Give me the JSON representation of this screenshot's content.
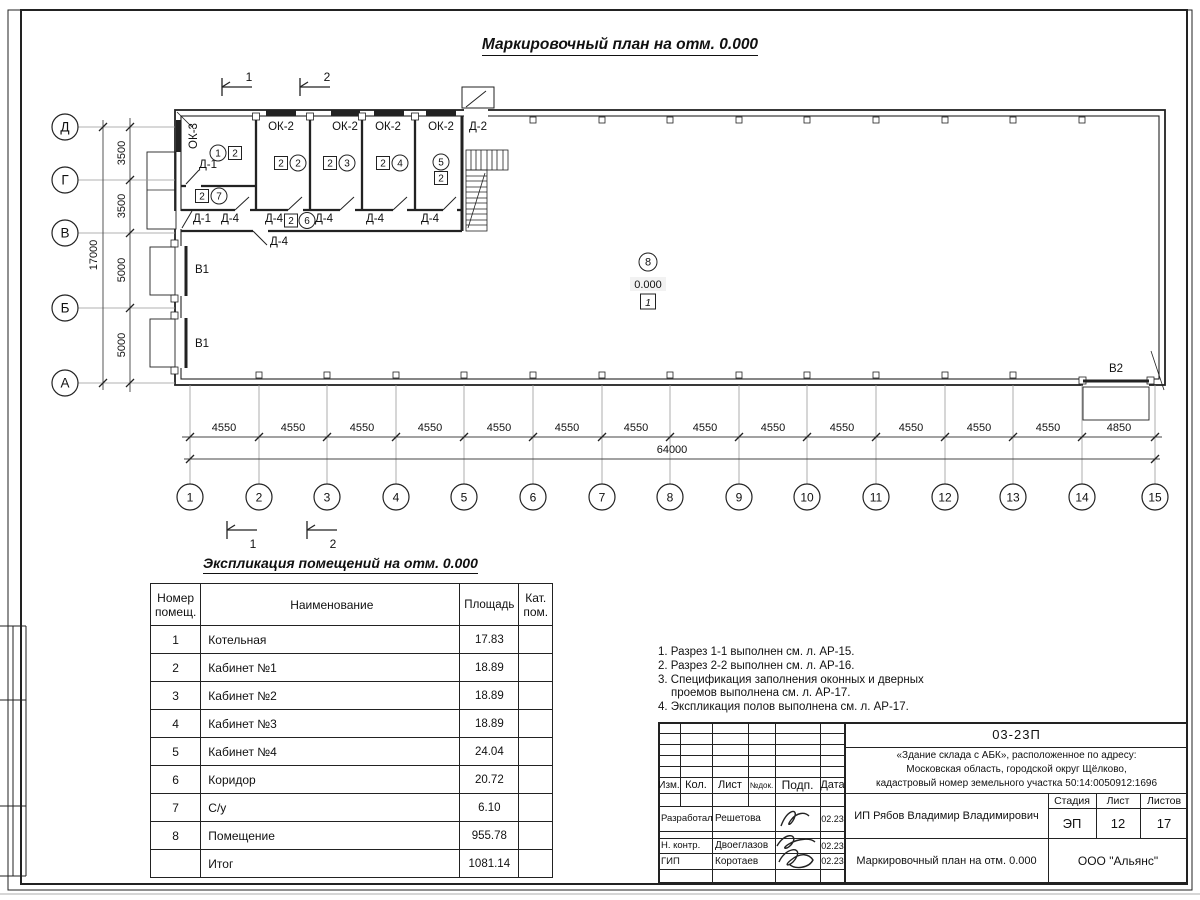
{
  "sheet": {
    "title": "Маркировочный план на отм. 0.000",
    "table_title": "Экспликация помещений на отм. 0.000"
  },
  "plan": {
    "axes_left": [
      "Д",
      "Г",
      "В",
      "Б",
      "А"
    ],
    "axes_bottom": [
      "1",
      "2",
      "3",
      "4",
      "5",
      "6",
      "7",
      "8",
      "9",
      "10",
      "11",
      "12",
      "13",
      "14",
      "15"
    ],
    "dims_bottom": [
      "4550",
      "4550",
      "4550",
      "4550",
      "4550",
      "4550",
      "4550",
      "4550",
      "4550",
      "4550",
      "4550",
      "4550",
      "4550",
      "4850"
    ],
    "dim_bottom_total": "64000",
    "dims_left": [
      "3500",
      "3500",
      "5000",
      "5000"
    ],
    "dim_left_total": "17000",
    "sections": {
      "s1": "1",
      "s2": "2"
    },
    "labels": {
      "ok2": "ОК-2",
      "ok3": "ОК-3",
      "d1": "Д-1",
      "d2": "Д-2",
      "d4": "Д-4",
      "v1": "В1",
      "v2": "В2"
    },
    "tags": {
      "r1": "1",
      "r2": "2",
      "r3": "3",
      "r4": "4",
      "r5": "5",
      "r6": "6",
      "r7": "7",
      "r8": "8",
      "cat": "2",
      "elevation": "0.000",
      "floor_type": "1"
    }
  },
  "notes": [
    "1. Разрез 1-1 выполнен см. л. АР-15.",
    "2. Разрез 2-2 выполнен см. л. АР-16.",
    "3. Спецификация заполнения оконных и дверных",
    "проемов выполнена см. л. АР-17.",
    "4. Экспликация полов выполнена см. л. АР-17."
  ],
  "table": {
    "headers": {
      "num": "Номер помещ.",
      "name": "Наименование",
      "area": "Площадь",
      "cat": "Кат. пом."
    },
    "rows": [
      {
        "num": "1",
        "name": "Котельная",
        "area": "17.83",
        "cat": ""
      },
      {
        "num": "2",
        "name": "Кабинет №1",
        "area": "18.89",
        "cat": ""
      },
      {
        "num": "3",
        "name": "Кабинет №2",
        "area": "18.89",
        "cat": ""
      },
      {
        "num": "4",
        "name": "Кабинет №3",
        "area": "18.89",
        "cat": ""
      },
      {
        "num": "5",
        "name": "Кабинет №4",
        "area": "24.04",
        "cat": ""
      },
      {
        "num": "6",
        "name": "Коридор",
        "area": "20.72",
        "cat": ""
      },
      {
        "num": "7",
        "name": "С/у",
        "area": "6.10",
        "cat": ""
      },
      {
        "num": "8",
        "name": "Помещение",
        "area": "955.78",
        "cat": ""
      },
      {
        "num": "",
        "name": "Итог",
        "area": "1081.14",
        "cat": ""
      }
    ]
  },
  "titleblock": {
    "doc_code": "03-23П",
    "project_line1": "«Здание склада с АБК», расположенное по адресу:",
    "project_line2": "Московская область, городской округ Щёлково,",
    "project_line3": "кадастровый номер земельного участка 50:14:0050912:1696",
    "col_izm": "Изм.",
    "col_kol": "Кол.",
    "col_list": "Лист",
    "col_ndok": "№док.",
    "col_podp": "Подп.",
    "col_data": "Дата",
    "role1": "Разработал",
    "name1": "Решетова",
    "date1": "02.23",
    "role2": "Н. контр.",
    "name2": "Двоеглазов",
    "date2": "02.23",
    "role3": "ГИП",
    "name3": "Коротаев",
    "date3": "02.23",
    "client": "ИП Рябов Владимир Владимирович",
    "stage_label": "Стадия",
    "sheet_label": "Лист",
    "sheets_label": "Листов",
    "stage": "ЭП",
    "sheet_no": "12",
    "sheets_total": "17",
    "drawing_title": "Маркировочный план на отм. 0.000",
    "company": "ООО \"Альянс\""
  }
}
